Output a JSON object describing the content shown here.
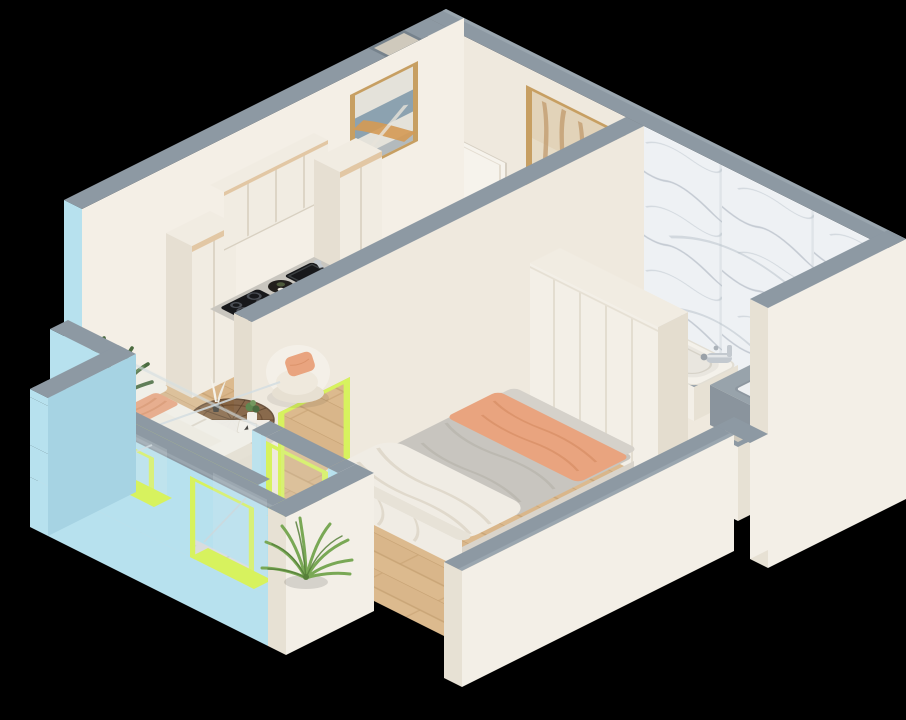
{
  "scene": {
    "kind": "isometric-apartment-cutaway-render",
    "background": "#000000",
    "view": "axonometric from south-east above",
    "rooms": [
      {
        "name": "kitchen-living-room",
        "floor": "light-wood-planks"
      },
      {
        "name": "bedroom",
        "floor": "light-wood-planks"
      },
      {
        "name": "bathroom",
        "floor": "marble-tile",
        "feature_wall": "white-marble-gray-veins"
      },
      {
        "name": "balcony",
        "floor": "marble-tile",
        "outer_walls": "light-blue",
        "frames": "lime-green"
      }
    ],
    "wall_decor": [
      {
        "name": "abstract-painting",
        "frame": "gold",
        "colors": [
          "blue-gray",
          "orange",
          "white"
        ],
        "location": "kitchen wall"
      },
      {
        "name": "trees-painting",
        "frame": "gold",
        "colors": [
          "beige",
          "tan"
        ],
        "location": "entry wall"
      }
    ],
    "furniture": {
      "kitchen": [
        "tall-cabinet-left",
        "tall-cabinet-right",
        "upper-cabinets",
        "base-cabinets",
        "marble-countertop",
        "black-sink",
        "chrome-faucet",
        "induction-hob",
        "oven",
        "round-tray"
      ],
      "dining": [
        {
          "name": "dining-table",
          "color": "white"
        },
        {
          "name": "dining-chair",
          "count": 4,
          "color": "cream"
        },
        "flower-vase",
        {
          "name": "placemat",
          "count": 2
        }
      ],
      "living": [
        "armchair-with-peach-pillow",
        "round-glass-coffee-table",
        "white-tray",
        "decor-feathers",
        "small-plant",
        "book",
        "sofa-with-peach-throw",
        "floor-plant"
      ],
      "bedroom": [
        "double-bed",
        "gray-blanket",
        "peach-throw",
        "white-duvet",
        "wardrobe"
      ],
      "bathroom": [
        "bathtub",
        "chrome-tub-faucet",
        "gray-vanity-counter",
        "inset-sink",
        "vent-shaft"
      ],
      "balcony": [
        "palm-plant"
      ]
    },
    "openings": [
      "entry-door",
      "living-window",
      "bedroom-balcony-door",
      "interior-door-lime-frame",
      "balcony-window",
      "balcony-door",
      "corner-niche"
    ]
  },
  "palette": {
    "background": "#000000",
    "wallTop": "#8d99a3",
    "wallTopLight": "#9aa6af",
    "blueWall": "#b7e1ee",
    "blueWallDeep": "#a6d3e3",
    "lime": "#d7f25e",
    "limeDeep": "#c4e14e",
    "creamWall": "#efe9de",
    "creamWallLight": "#f4efe6",
    "creamWallShade": "#e4ddcf",
    "slabWhite": "#f3efe7",
    "slabShade": "#e7e1d4",
    "wood": "#dcba8e",
    "woodSeam": "#c6a173",
    "marbleFloor": "#d9dcde",
    "marbleSeam": "#c3c8cc",
    "marbleWall": "#eef1f4",
    "marbleVein": "#b6bfc8",
    "cabinet": "#f1ece2",
    "cabinetShade": "#e6dfd2",
    "tanTrim": "#e2c7a4",
    "counterTop": "#c9c6bf",
    "dark": "#17181b",
    "chrome": "#c3c9cf",
    "grayCounter": "#98a3ab",
    "grayCounterFace": "#8a949d",
    "doorWhite": "#f6f3ec",
    "gold": "#c79f62",
    "furnCream": "#f4f0e8",
    "furnCreamShade": "#e7e0d2",
    "peach": "#e9a47f",
    "peachDeep": "#d68c63",
    "bedGray": "#c8c5bf",
    "bedGrayDeep": "#b4b0a8",
    "duvet": "#f0ece4",
    "duvetShade": "#ded7c9",
    "brownGlass": "#7c5939",
    "brownDeep": "#59402a",
    "plantDark": "#4b6b40",
    "plantMid": "#5f8750",
    "palm": "#79a855",
    "palmDeep": "#567f39",
    "paintBlue": "#7d97a8",
    "paintOrange": "#d49a54",
    "paintCanvas": "#e7dcc6",
    "glass": "#dfe9ec"
  }
}
